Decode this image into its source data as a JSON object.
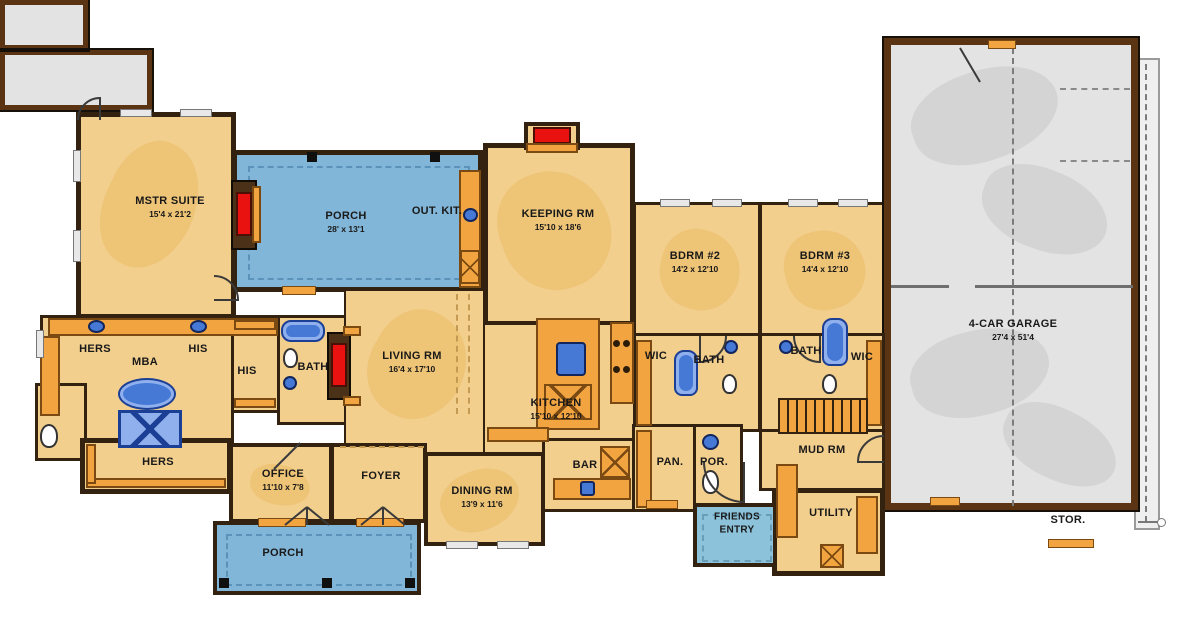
{
  "palette": {
    "tan": "#f3cf8e",
    "tanBlob": "#ecc172",
    "wall": "#33220f",
    "wallBrown": "#5a3413",
    "porchBlue": "#82b6d8",
    "porchDash": "#4d87b0",
    "friendsBlue": "#8cc2da",
    "garageGray": "#e3e3e3",
    "garageBlob": "#d2d2d2",
    "flapGray": "#efefef",
    "orange": "#f2a440",
    "orangeBrd": "#7a4a12",
    "red": "#ea1111",
    "fixBlue": "#4679d6",
    "fixBlueLight": "#8fb0ec",
    "fixBlueBrd": "#1c3f96",
    "ink": "#191919"
  },
  "labels": {
    "mstr_suite": {
      "name": "MSTR SUITE",
      "dims": "15'4 x 21'2"
    },
    "porch_top": {
      "name": "PORCH",
      "dims": "28' x 13'1"
    },
    "out_kit": {
      "name": "OUT. KIT."
    },
    "keeping": {
      "name": "KEEPING RM",
      "dims": "15'10 x 18'6"
    },
    "bdrm2": {
      "name": "BDRM #2",
      "dims": "14'2 x 12'10"
    },
    "bdrm3": {
      "name": "BDRM #3",
      "dims": "14'4 x 12'10"
    },
    "garage": {
      "name": "4-CAR GARAGE",
      "dims": "27'4 x 51'4"
    },
    "hers_vanity": {
      "name": "HERS"
    },
    "mba": {
      "name": "MBA"
    },
    "his_vanity": {
      "name": "HIS"
    },
    "his_closet": {
      "name": "HIS"
    },
    "mbath": {
      "name": "BATH"
    },
    "living": {
      "name": "LIVING RM",
      "dims": "16'4 x 17'10"
    },
    "kitchen": {
      "name": "KITCHEN",
      "dims": "15'10 x 12'10"
    },
    "wic2": {
      "name": "WIC"
    },
    "bath2": {
      "name": "BATH"
    },
    "bath3": {
      "name": "BATH"
    },
    "wic3": {
      "name": "WIC"
    },
    "hers_closet": {
      "name": "HERS"
    },
    "office": {
      "name": "OFFICE",
      "dims": "11'10 x 7'8"
    },
    "foyer": {
      "name": "FOYER"
    },
    "dining": {
      "name": "DINING RM",
      "dims": "13'9 x 11'6"
    },
    "bar": {
      "name": "BAR"
    },
    "pan": {
      "name": "PAN."
    },
    "por": {
      "name": "POR."
    },
    "mud": {
      "name": "MUD RM"
    },
    "utility": {
      "name": "UTILITY"
    },
    "friends_entry": {
      "name": "FRIENDS ENTRY"
    },
    "porch_bottom": {
      "name": "PORCH"
    },
    "stor": {
      "name": "STOR."
    }
  }
}
